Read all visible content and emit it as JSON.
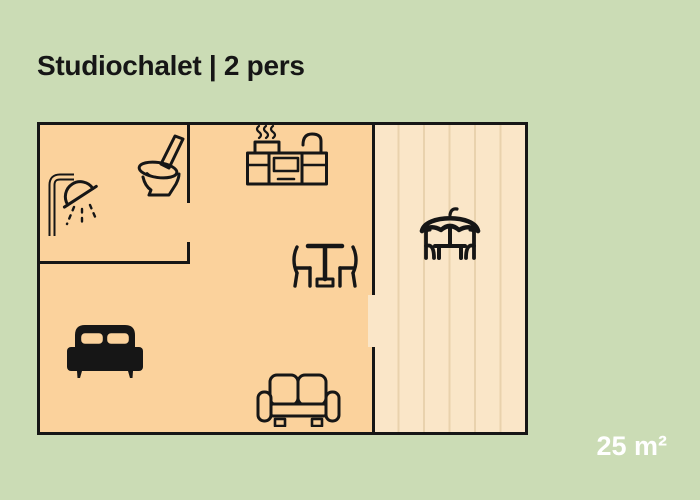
{
  "title": "Studiochalet | 2 pers",
  "area_label": "25 m²",
  "colors": {
    "bg": "#cbdcb5",
    "room": "#fbd29c",
    "terrace": "#fae6c8",
    "plank": "#e9d2ad",
    "line": "#161616",
    "area": "#ffffff"
  },
  "floorplan": {
    "icons": [
      "shower-icon",
      "toilet-icon",
      "kitchen-icon",
      "dining-table-icon",
      "parasol-table-icon",
      "bed-icon",
      "sofa-icon"
    ]
  }
}
